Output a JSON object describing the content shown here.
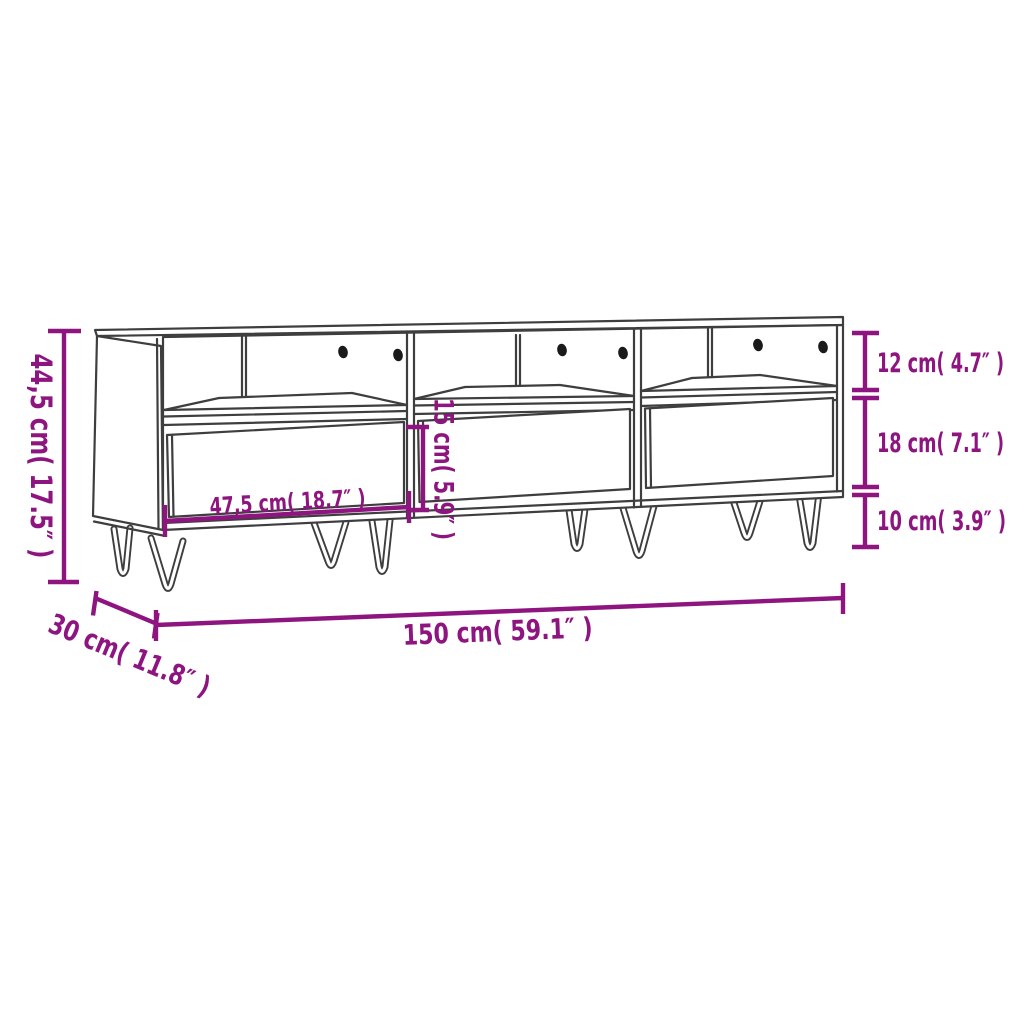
{
  "diagram": {
    "subject": "cabinet-dimension-drawing",
    "colors": {
      "dimension": "#8e1580",
      "line_art": "#3e3e3e",
      "background": "#ffffff",
      "holes": "#1a1a1a"
    },
    "labels": {
      "overall_height": "44,5 cm( 17.5″ )",
      "compartment_height": "12 cm( 4.7″ )",
      "drawer_height": "18 cm( 7.1″ )",
      "leg_height": "10 cm( 3.9″ )",
      "inner_height": "15 cm( 5.9″ )",
      "drawer_width": "47,5 cm( 18.7″ )",
      "overall_width": "150 cm( 59.1″ )",
      "depth": "30 cm( 11.8″ )"
    }
  }
}
